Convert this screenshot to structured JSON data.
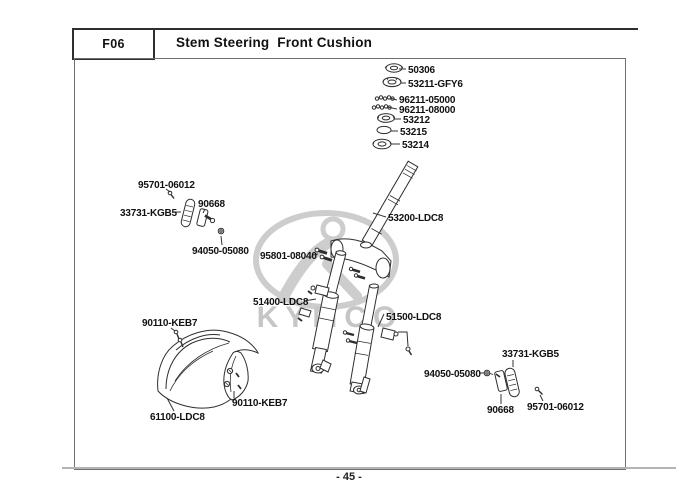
{
  "header": {
    "code": "F06",
    "title": "Stem Steering  Front Cushion"
  },
  "watermark": {
    "brand": "KYMCO"
  },
  "footer": {
    "page_number": "- 45 -"
  },
  "colors": {
    "line_art": "#2e2e2e",
    "label_text": "#111111",
    "watermark_gray": "#cdcdcd",
    "footer_line": "#b4b4b4",
    "frame_border": "#707070"
  },
  "diagram": {
    "labels": [
      {
        "id": "50306",
        "text": "50306",
        "x": 408,
        "y": 73,
        "leader": [
          [
            399,
            69
          ],
          [
            406,
            69
          ]
        ]
      },
      {
        "id": "53211-gfy6",
        "text": "53211-GFY6",
        "x": 408,
        "y": 87,
        "leader": [
          [
            401,
            83
          ],
          [
            406,
            83
          ]
        ]
      },
      {
        "id": "96211-05000",
        "text": "96211-05000",
        "x": 399,
        "y": 103,
        "leader": [
          [
            390,
            98
          ],
          [
            397,
            100
          ]
        ]
      },
      {
        "id": "96211-08000",
        "text": "96211-08000",
        "x": 399,
        "y": 113,
        "leader": [
          [
            387,
            107
          ],
          [
            397,
            109
          ]
        ]
      },
      {
        "id": "53212",
        "text": "53212",
        "x": 403,
        "y": 123,
        "leader": [
          [
            394,
            119
          ],
          [
            401,
            119
          ]
        ]
      },
      {
        "id": "53215",
        "text": "53215",
        "x": 400,
        "y": 135,
        "leader": [
          [
            391,
            131
          ],
          [
            398,
            131
          ]
        ]
      },
      {
        "id": "53214",
        "text": "53214",
        "x": 402,
        "y": 148,
        "leader": [
          [
            391,
            144
          ],
          [
            400,
            144
          ]
        ]
      },
      {
        "id": "53200-ldc8",
        "text": "53200-LDC8",
        "x": 388,
        "y": 221,
        "leader": [
          [
            373,
            213
          ],
          [
            386,
            217
          ]
        ]
      },
      {
        "id": "95801-08040",
        "text": "95801-08040",
        "x": 260,
        "y": 259,
        "leader": [
          [
            313,
            255
          ],
          [
            318,
            254
          ]
        ]
      },
      {
        "id": "95701-06012-l",
        "text": "95701-06012",
        "x": 138,
        "y": 188,
        "leader": [
          [
            166,
            189
          ],
          [
            170,
            192
          ]
        ]
      },
      {
        "id": "33731-kgb5-l",
        "text": "33731-KGB5",
        "x": 120,
        "y": 216,
        "leader": [
          [
            174,
            212
          ],
          [
            181,
            212
          ]
        ]
      },
      {
        "id": "90668-l",
        "text": "90668",
        "x": 198,
        "y": 207,
        "leader": [
          [
            205,
            209
          ],
          [
            203,
            213
          ]
        ]
      },
      {
        "id": "94050-05080-l",
        "text": "94050-05080",
        "x": 192,
        "y": 254,
        "leader": [
          [
            221,
            236
          ],
          [
            222,
            245
          ]
        ]
      },
      {
        "id": "51400-ldc8",
        "text": "51400-LDC8",
        "x": 253,
        "y": 305,
        "leader": [
          [
            304,
            301
          ],
          [
            316,
            299
          ]
        ]
      },
      {
        "id": "51500-ldc8",
        "text": "51500-LDC8",
        "x": 386,
        "y": 320,
        "leader": [
          [
            384,
            314
          ],
          [
            378,
            327
          ]
        ]
      },
      {
        "id": "90110-keb7-t",
        "text": "90110-KEB7",
        "x": 142,
        "y": 326,
        "leader": [
          [
            171,
            328
          ],
          [
            175,
            331
          ]
        ]
      },
      {
        "id": "61100-ldc8",
        "text": "61100-LDC8",
        "x": 150,
        "y": 420,
        "leader": [
          [
            167,
            398
          ],
          [
            174,
            411
          ]
        ]
      },
      {
        "id": "90110-keb7-b",
        "text": "90110-KEB7",
        "x": 232,
        "y": 406,
        "leader": [
          [
            234,
            391
          ],
          [
            234,
            398
          ]
        ]
      },
      {
        "id": "33731-kgb5-r",
        "text": "33731-KGB5",
        "x": 502,
        "y": 357,
        "leader": [
          [
            513,
            360
          ],
          [
            513,
            367
          ]
        ]
      },
      {
        "id": "94050-05080-r",
        "text": "94050-05080",
        "x": 424,
        "y": 377,
        "leader": [
          [
            479,
            373
          ],
          [
            484,
            373
          ]
        ]
      },
      {
        "id": "90668-r",
        "text": "90668",
        "x": 487,
        "y": 413,
        "leader": [
          [
            501,
            394
          ],
          [
            501,
            404
          ]
        ]
      },
      {
        "id": "95701-06012-r",
        "text": "95701-06012",
        "x": 527,
        "y": 410,
        "leader": [
          [
            540,
            395
          ],
          [
            543,
            401
          ]
        ]
      }
    ]
  }
}
